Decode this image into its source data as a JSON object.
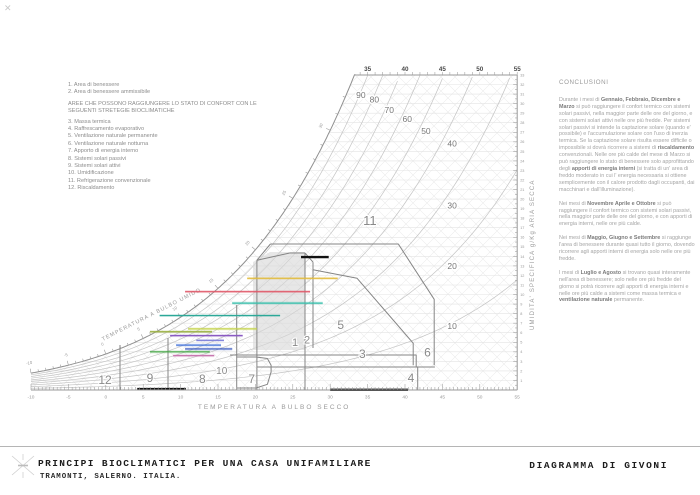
{
  "legend": {
    "items_top": [
      "1. Area di benessere",
      "2. Area di benessere ammissibile"
    ],
    "header": "AREE CHE POSSONO RAGGIUNGERE LO STATO DI CONFORT CON LE SEGUENTI STRETEGIE BIOCLIMATICHE",
    "items": [
      "3. Massa termica",
      "4. Raffrescamento evaporativo",
      "5. Ventilazione naturale permanente",
      "6. Ventilazione naturale notturna",
      "7. Apporto di energia interno",
      "8. Sistemi solari passivi",
      "9. Sistemi solari attivi",
      "10. Umidificazione",
      "11. Refrigerazione convenzionale",
      "12. Riscaldamento"
    ]
  },
  "conclusions": {
    "title": "CONCLUSIONI",
    "paragraphs": [
      [
        {
          "t": "Durante i mesi di ",
          "b": false
        },
        {
          "t": "Gennaio, Febbraio, Dicembre e Marzo",
          "b": true
        },
        {
          "t": " si può raggiungere il confort termico con sistemi solari passivi, nella maggior parte delle ore del giorno, e con sistemi solari attivi nelle ore più fredde. Per sistemi solari passivi si intende la captazione solare (quando e' possibile) e l'accumulazione solare con l'uso di inerzia termica. Se la captazione solare risulta essere difficile o impossibile si dovrà ricorrere a sistemi di ",
          "b": false
        },
        {
          "t": "riscaldamento",
          "b": true
        },
        {
          "t": " convenzionali. Nelle ore più calde del mese di Marzo si può raggiungere lo stato di benessere solo approfittando degli ",
          "b": false
        },
        {
          "t": "apporti di energia interni",
          "b": true
        },
        {
          "t": " (si tratta di un' area di freddo moderato in cui l' energia necessaria si ottiene semplicemente con il calore prodotto dagli occupanti, dai macchinari e dall'illuminazione).",
          "b": false
        }
      ],
      [
        {
          "t": "Nei mesi di ",
          "b": false
        },
        {
          "t": "Novembre Aprile e Ottobre",
          "b": true
        },
        {
          "t": " si può raggiungere il confort termico con sistemi solari passivi, nella maggior parte delle ore del giorno, e con apporti di energia interni, nelle ore più calde.",
          "b": false
        }
      ],
      [
        {
          "t": "Nei mesi di ",
          "b": false
        },
        {
          "t": "Maggio, Giugno e Settembre",
          "b": true
        },
        {
          "t": " si raggiunge l'area di benessere durante quasi tutto il giorno, dovendo ricorrere agli apporti interni di energia solo nelle ore più fredde.",
          "b": false
        }
      ],
      [
        {
          "t": "I mesi di ",
          "b": false
        },
        {
          "t": "Luglio e Agosto",
          "b": true
        },
        {
          "t": " si trovano quasi interamente nell'area di benessere; solo nelle ore più fredde del giorno si potrà ricorrere agli apporti di energia interni e nelle ore più calde a sistemi come massa termica e ",
          "b": false
        },
        {
          "t": "ventilazione naturale",
          "b": true
        },
        {
          "t": " permanente.",
          "b": false
        }
      ]
    ]
  },
  "titleblock": {
    "title": "PRINCIPI BIOCLIMATICI PER UNA CASA UNIFAMILIARE",
    "subtitle": "TRAMONTI, SALERNO. ITALIA.",
    "right_title": "DIAGRAMMA DI GIVONI"
  },
  "chart_data": {
    "type": "psychrometric-givoni-bioclimatic",
    "x_axis": {
      "label": "TEMPERATURA A BULBO SECCO",
      "min": -10,
      "max": 55,
      "tick_labels": [
        -10,
        -5,
        0,
        5,
        10,
        15,
        20,
        25,
        30,
        35,
        40,
        45,
        50,
        55
      ]
    },
    "top_axis": {
      "tick_labels": [
        35,
        40,
        45,
        50,
        55
      ]
    },
    "y_axis_right": {
      "label": "UMIDITA'  SPECIFICA  g/Kg  ARIA  SECCA",
      "min": 0,
      "max": 33,
      "tick_step": 1
    },
    "wet_bulb_axis": {
      "label": "TEMPERATURA A BULBO UMIDO",
      "tick_labels": [
        -10,
        -5,
        0,
        5,
        10,
        15,
        20,
        25,
        30
      ]
    },
    "rh_curves": {
      "percent": [
        10,
        20,
        30,
        40,
        50,
        60,
        70,
        80,
        90
      ],
      "labels": [
        {
          "v": "90",
          "T": 34.1,
          "w": 30.6
        },
        {
          "v": "80",
          "T": 35.9,
          "w": 30.1
        },
        {
          "v": "70",
          "T": 37.9,
          "w": 29.0
        },
        {
          "v": "60",
          "T": 40.3,
          "w": 28.1
        },
        {
          "v": "50",
          "T": 42.8,
          "w": 26.8
        },
        {
          "v": "40",
          "T": 46.3,
          "w": 25.5
        },
        {
          "v": "30",
          "T": 46.3,
          "w": 19.0
        },
        {
          "v": "20",
          "T": 46.3,
          "w": 12.7
        },
        {
          "v": "10",
          "T": 46.3,
          "w": 6.4
        }
      ]
    },
    "zones": {
      "comfort_fill": [
        [
          19.68,
          4.19
        ],
        [
          19.68,
          13.41
        ],
        [
          21.95,
          14.46
        ],
        [
          26.63,
          14.46
        ],
        [
          26.63,
          4.19
        ]
      ],
      "outlines": [
        [
          [
            17.5,
            8.9
          ],
          [
            17.5,
            0
          ]
        ],
        [
          [
            20.2,
            13.6
          ],
          [
            20.2,
            0
          ]
        ],
        [
          [
            26.63,
            14.35
          ],
          [
            26.63,
            0
          ]
        ],
        [
          [
            20.2,
            13.6
          ],
          [
            24.6,
            14.35
          ]
        ],
        [
          [
            24.6,
            14.35
          ],
          [
            26.63,
            14.35
          ]
        ],
        [
          [
            27.7,
            13.4
          ],
          [
            27.7,
            4.4
          ]
        ],
        [
          [
            26.63,
            14.35
          ],
          [
            27.7,
            13.4
          ]
        ],
        [
          [
            22.0,
            15.3
          ],
          [
            39.1,
            15.3
          ],
          [
            43.9,
            9.5
          ],
          [
            43.9,
            2.6
          ]
        ],
        [
          [
            22.0,
            15.3
          ],
          [
            20.2,
            13.6
          ]
        ],
        [
          [
            27.7,
            12.6
          ],
          [
            33.6,
            11.7
          ],
          [
            41.1,
            4.9
          ],
          [
            41.1,
            2.6
          ]
        ],
        [
          [
            16.6,
            3.67
          ],
          [
            41.5,
            3.67
          ],
          [
            41.5,
            2.41
          ]
        ],
        [
          [
            20.2,
            2.41
          ],
          [
            44.0,
            2.41
          ]
        ],
        [
          [
            41.7,
            2.41
          ],
          [
            41.7,
            0
          ]
        ],
        [
          [
            17.5,
            3.46
          ],
          [
            20.1,
            3.46
          ],
          [
            21.6,
            3.3
          ],
          [
            22.1,
            2.6
          ],
          [
            22.1,
            1.9
          ],
          [
            21.6,
            0.6
          ],
          [
            20.1,
            0.21
          ],
          [
            17.5,
            0.21
          ]
        ],
        [
          [
            1.9,
            4.71
          ],
          [
            1.9,
            0
          ]
        ],
        [
          [
            8.32,
            5.45
          ],
          [
            8.32,
            0
          ]
        ]
      ],
      "labels": [
        {
          "t": "12",
          "T": -0.1,
          "w": 0.65,
          "s": 12
        },
        {
          "t": "9",
          "T": 5.9,
          "w": 0.85,
          "s": 12
        },
        {
          "t": "8",
          "T": 12.9,
          "w": 0.75,
          "s": 12
        },
        {
          "t": "10",
          "T": 15.5,
          "w": 1.7,
          "s": 10
        },
        {
          "t": "7",
          "T": 19.5,
          "w": 0.75,
          "s": 12
        },
        {
          "t": "1",
          "T": 25.3,
          "w": 4.6,
          "s": 11
        },
        {
          "t": "2",
          "T": 26.9,
          "w": 4.85,
          "s": 11
        },
        {
          "t": "5",
          "T": 31.4,
          "w": 6.4,
          "s": 12
        },
        {
          "t": "3",
          "T": 34.3,
          "w": 3.35,
          "s": 12
        },
        {
          "t": "6",
          "T": 43.0,
          "w": 3.5,
          "s": 12
        },
        {
          "t": "4",
          "T": 40.8,
          "w": 0.85,
          "s": 12
        },
        {
          "t": "11",
          "T": 35.3,
          "w": 17.3,
          "s": 13
        }
      ]
    },
    "month_lines": [
      {
        "color": "#e2bc3c",
        "w": 11.7,
        "t1": 18.9,
        "t2": 31.0
      },
      {
        "color": "#e05868",
        "w": 10.3,
        "t1": 10.6,
        "t2": 27.3
      },
      {
        "color": "#38c0ac",
        "w": 9.1,
        "t1": 16.9,
        "t2": 29.0
      },
      {
        "color": "#2ca898",
        "w": 7.8,
        "t1": 7.2,
        "t2": 23.3
      },
      {
        "color": "#c6d44e",
        "w": 6.4,
        "t1": 11.0,
        "t2": 20.2
      },
      {
        "color": "#9ab040",
        "w": 6.1,
        "t1": 5.9,
        "t2": 14.2
      },
      {
        "color": "#8a5ac2",
        "w": 5.7,
        "t1": 8.6,
        "t2": 18.3
      },
      {
        "color": "#8486da",
        "w": 5.2,
        "t1": 12.1,
        "t2": 15.8
      },
      {
        "color": "#4a78dc",
        "w": 4.7,
        "t1": 9.4,
        "t2": 15.4
      },
      {
        "color": "#3a5ac0",
        "w": 4.3,
        "t1": 10.6,
        "t2": 16.9
      },
      {
        "color": "#48a848",
        "w": 4.0,
        "t1": 5.9,
        "t2": 13.9
      },
      {
        "color": "#c878b0",
        "w": 3.6,
        "t1": 9.0,
        "t2": 14.5
      }
    ],
    "thick_marks": [
      {
        "w": 13.93,
        "t1": 26.1,
        "t2": 29.8
      },
      {
        "w": 0.1,
        "t1": 4.2,
        "t2": 10.7
      },
      {
        "w": 0.02,
        "t1": 30.0,
        "t2": 40.4
      }
    ],
    "colors": {
      "grid": "#e3e3e3",
      "hatch": "#ececec",
      "rh_curve": "#c4c4c4",
      "zone_outline": "#858585",
      "axis": "#9a9a9a",
      "comfort_fill": "#d7d7d7",
      "label_text": "#8a8a8a",
      "thick_mark": "#111111"
    }
  }
}
